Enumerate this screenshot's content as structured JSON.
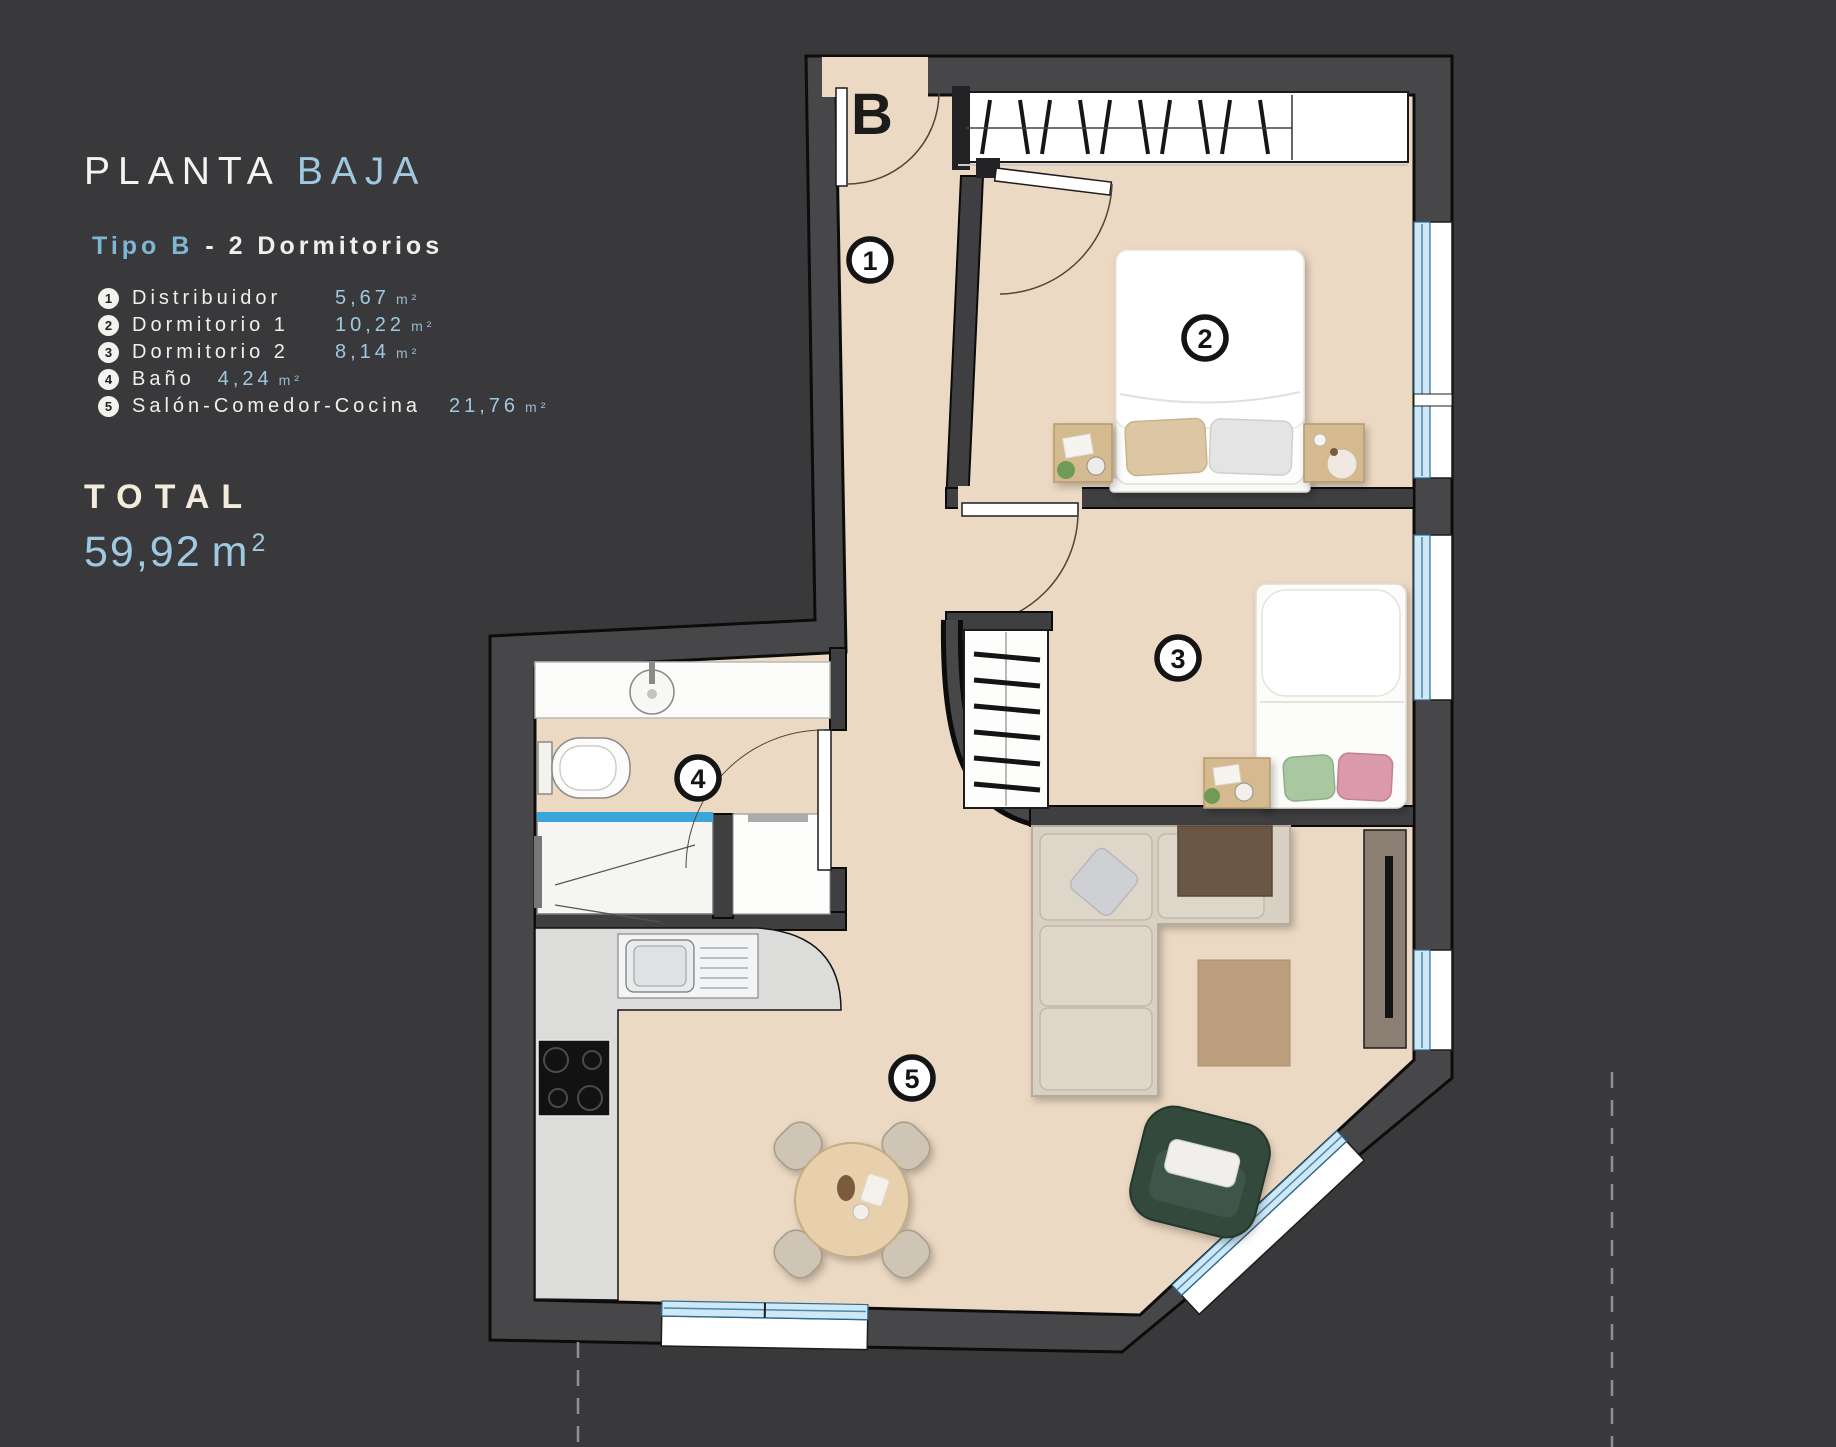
{
  "info_panel": {
    "title_main": "PLANTA",
    "title_accent": "BAJA",
    "subtitle_accent": "Tipo B",
    "subtitle_rest": "- 2  Dormitorios",
    "legend": [
      {
        "num": "1",
        "name": "Distribuidor",
        "area": "5,67",
        "unit": "m²"
      },
      {
        "num": "2",
        "name": "Dormitorio 1",
        "area": "10,22",
        "unit": "m²"
      },
      {
        "num": "3",
        "name": "Dormitorio 2",
        "area": "8,14",
        "unit": "m²"
      },
      {
        "num": "4",
        "name": "Baño",
        "area": "4,24",
        "unit": "m²"
      },
      {
        "num": "5",
        "name": "Salón-Comedor-Cocina",
        "area": "21,76",
        "unit": "m²"
      }
    ],
    "total_label": "TOTAL",
    "total_value": "59,92",
    "total_unit": "m",
    "total_sup": "2"
  },
  "floor_plan": {
    "entrance_label": "B",
    "markers": [
      "1",
      "2",
      "3",
      "4",
      "5"
    ]
  },
  "colors": {
    "bg": "#39393b",
    "accent-blue": "#9fc9e0",
    "accent-blue-strong": "#7db7d6",
    "cream": "#f3ecdc",
    "text-light": "#efefec",
    "floor": "#ecd9c3",
    "wall": "#474749",
    "window-glass": "#cfe8f7",
    "shower-glass": "#3aa5d8",
    "wood": "#d5ba90",
    "sofa": "#d8d0c2",
    "armchair-green": "#33493b",
    "rug": "#bb9f7e"
  }
}
